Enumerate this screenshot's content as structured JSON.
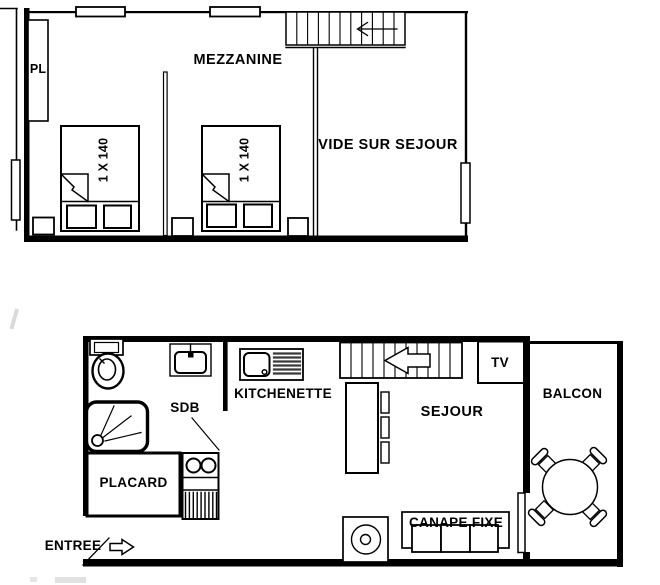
{
  "upper": {
    "title": "MEZZANINE",
    "void_label": "VIDE SUR SEJOUR",
    "closet": "PL",
    "bed1": "1 X 140",
    "bed2": "1 X 140"
  },
  "lower": {
    "kitchenette": "KITCHENETTE",
    "bathroom": "SDB",
    "closet": "PLACARD",
    "entrance": "ENTREE",
    "living": "SEJOUR",
    "tv": "TV",
    "balcony": "BALCON",
    "sofa": "CANAPE FIXE"
  },
  "colors": {
    "line": "#000000",
    "background": "#ffffff"
  }
}
